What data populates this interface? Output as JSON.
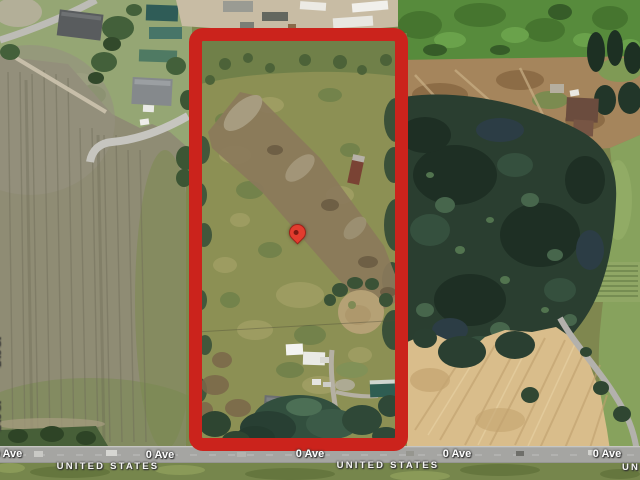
{
  "view": {
    "description": "Satellite map of a rural property parcel outlined in red with a location pin, bordered on the south by 0 Ave at the United States boundary"
  },
  "labels": {
    "road": "0 Ave",
    "country": "UNITED STATES",
    "side_street": "248 St"
  },
  "marker": {
    "kind": "red-map-pin",
    "fill": "#e23c2e",
    "center_dot": "#7c1a12"
  },
  "boundary": {
    "kind": "property-outline",
    "color": "#cb231c"
  },
  "terrain_colors": {
    "base_green": "#7f874f",
    "plowed_field": "#8f8c74",
    "forest": "#2a3e30",
    "harvested_field": "#d9bd8b",
    "gravel_yard": "#c8bca4",
    "road_surface": "#a5a5a2"
  }
}
